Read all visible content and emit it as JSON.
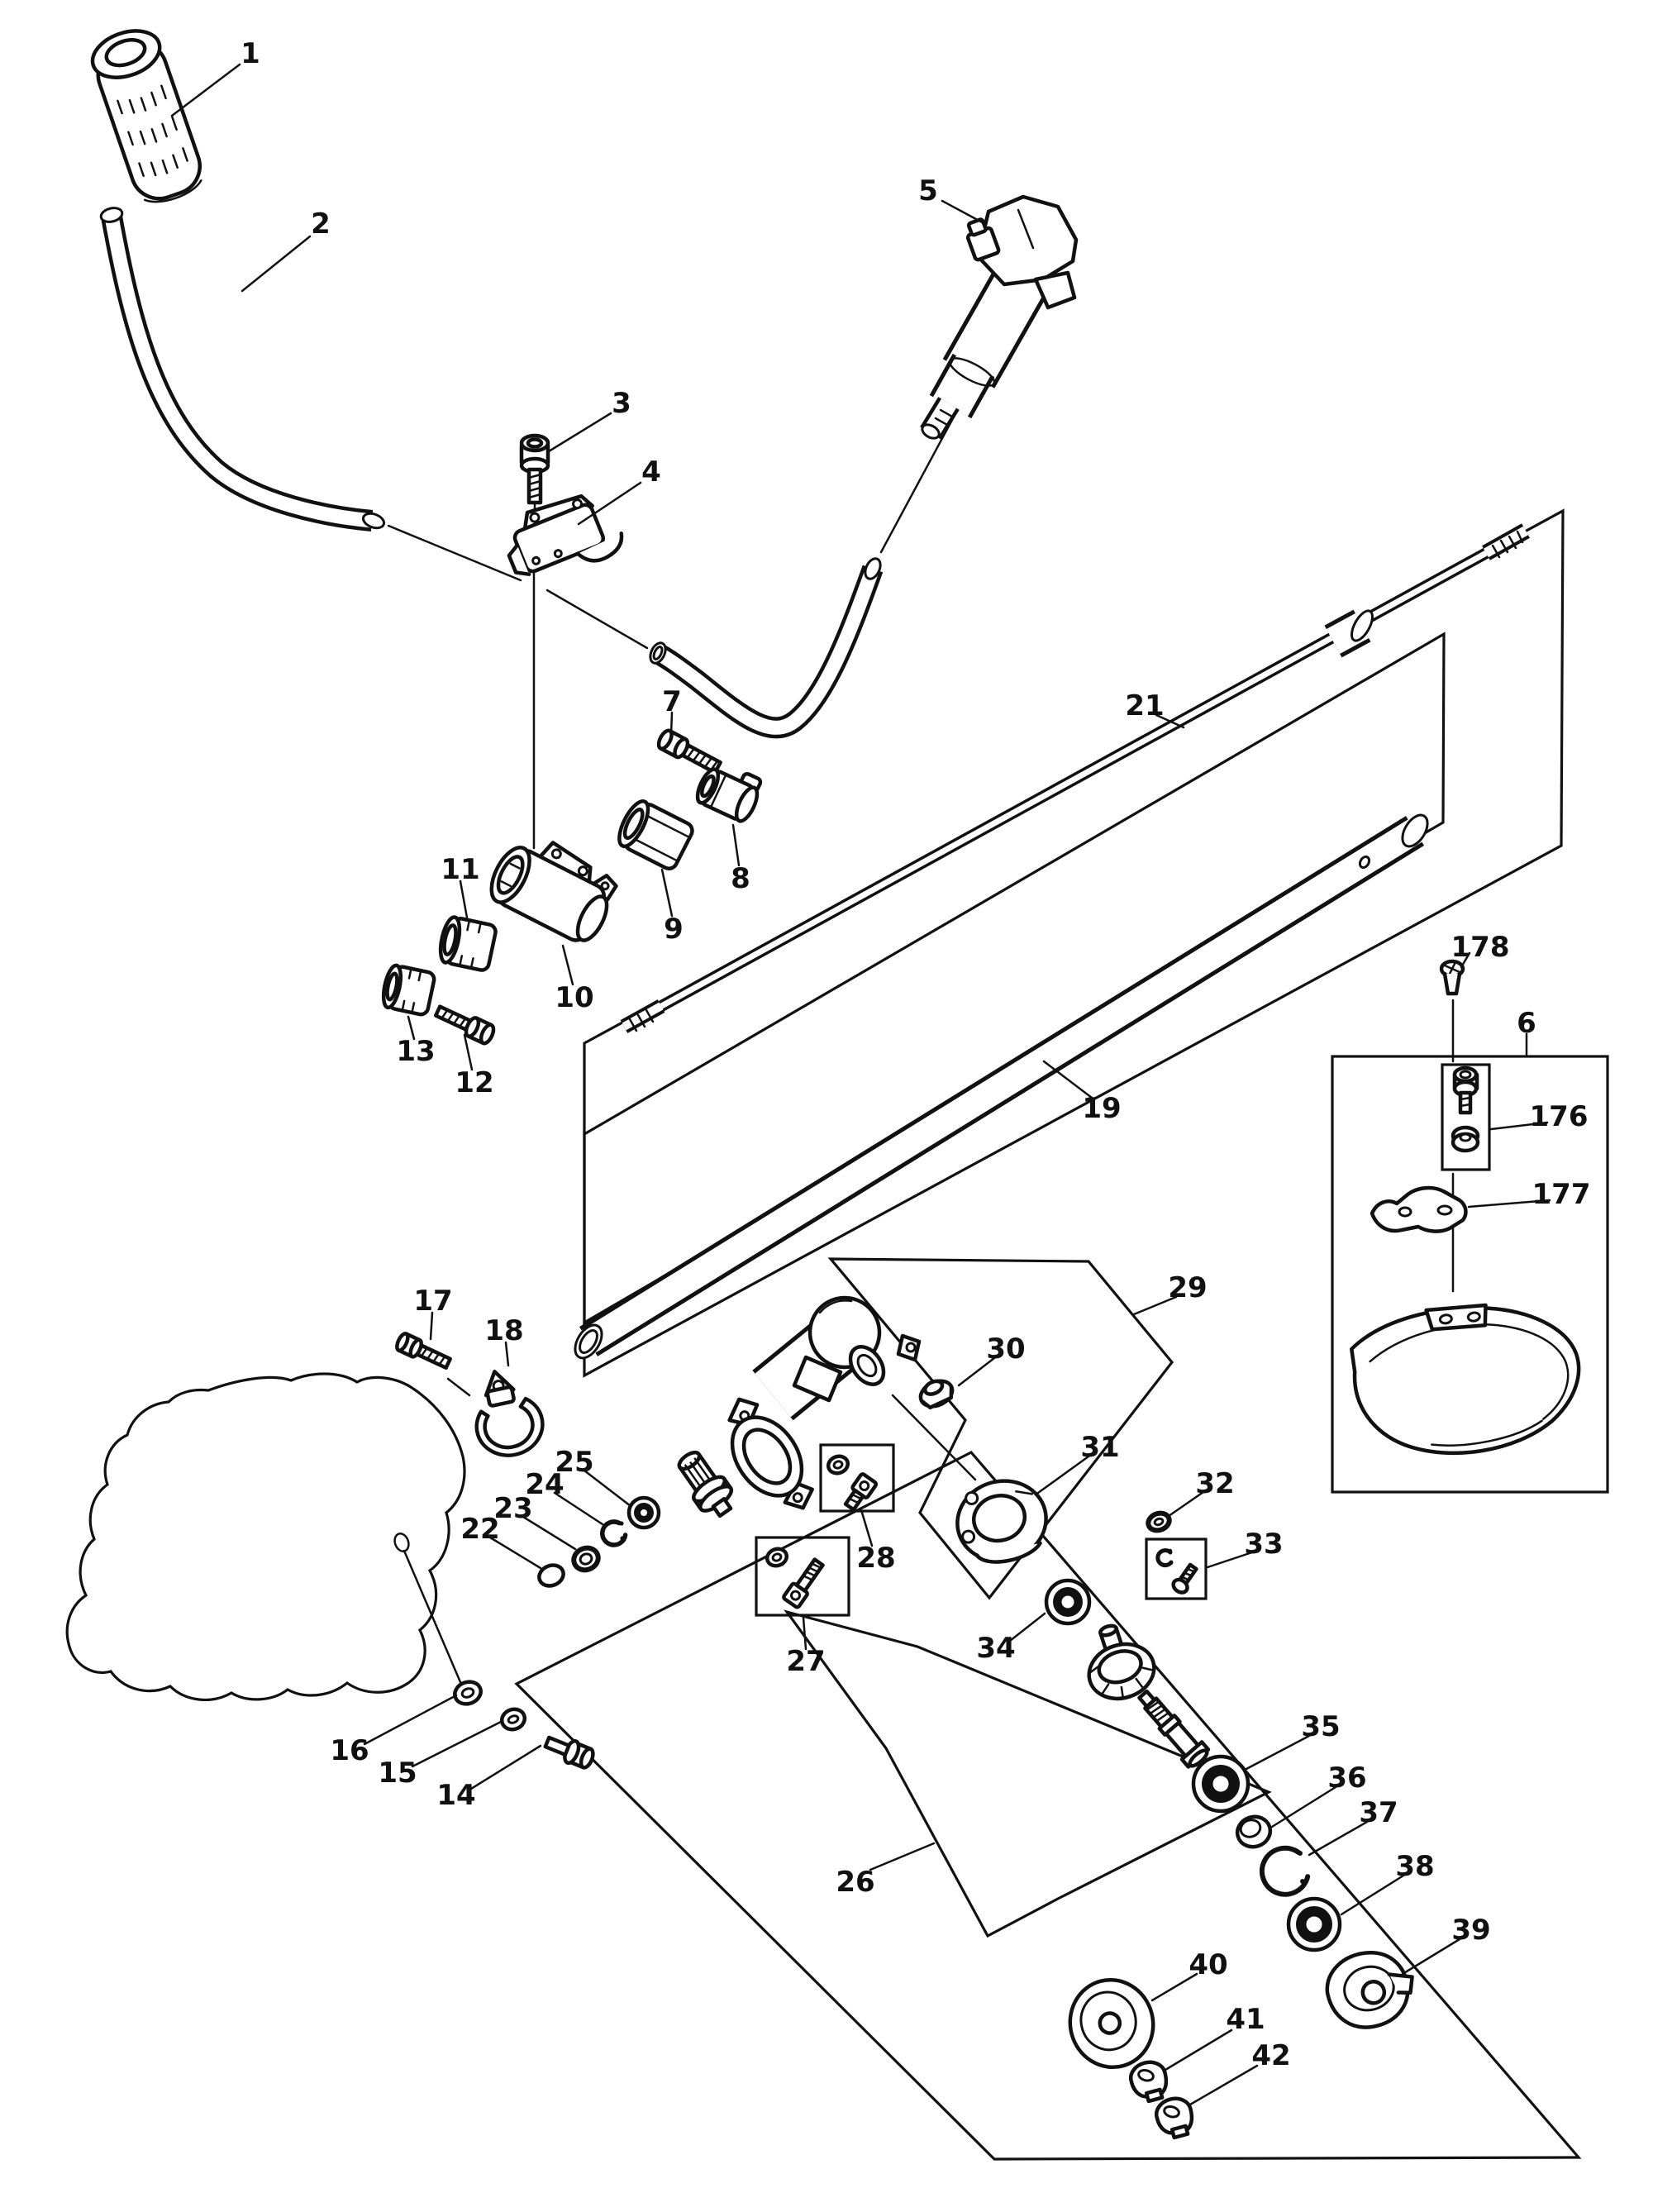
{
  "diagram": {
    "type": "exploded-parts-diagram",
    "colors": {
      "ink": "#111111",
      "background": "#ffffff"
    },
    "labels": {
      "p1": "1",
      "p2": "2",
      "p3": "3",
      "p4": "4",
      "p5": "5",
      "p6": "6",
      "p7": "7",
      "p8": "8",
      "p9": "9",
      "p10": "10",
      "p11": "11",
      "p12": "12",
      "p13": "13",
      "p14": "14",
      "p15": "15",
      "p16": "16",
      "p17": "17",
      "p18": "18",
      "p19": "19",
      "p21": "21",
      "p22": "22",
      "p23": "23",
      "p24": "24",
      "p25": "25",
      "p26": "26",
      "p27": "27",
      "p28": "28",
      "p29": "29",
      "p30": "30",
      "p31": "31",
      "p32": "32",
      "p33": "33",
      "p34": "34",
      "p35": "35",
      "p36": "36",
      "p37": "37",
      "p38": "38",
      "p39": "39",
      "p40": "40",
      "p41": "41",
      "p42": "42",
      "p176": "176",
      "p177": "177",
      "p178": "178"
    }
  }
}
